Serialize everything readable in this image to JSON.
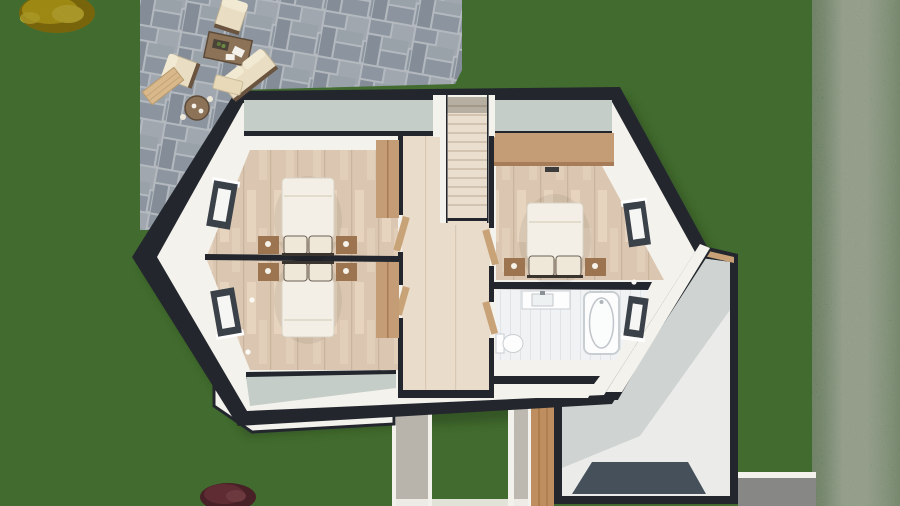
{
  "meta": {
    "kind": "3d-floorplan-top-down-render",
    "storey": "upper-floor-dollhouse-cutaway",
    "visible_text": ""
  },
  "environment": {
    "lawn": "grass lawn surrounding house",
    "hedge": "tall hedge along right edge",
    "patio": "grey paver patio, top left",
    "walkway": "gravel walkway at bottom centre",
    "gravel_strip": "gravel strip bottom right",
    "plants": [
      "yellow-shrub-top-left",
      "red-shrub-bottom"
    ]
  },
  "house": {
    "rooms": [
      {
        "name": "bedroom-top-left",
        "floor": "wood",
        "furniture": [
          "double-bed",
          "nightstand-left",
          "nightstand-right",
          "wardrobe"
        ]
      },
      {
        "name": "bedroom-bottom-left",
        "floor": "wood",
        "furniture": [
          "double-bed",
          "nightstand-left",
          "nightstand-right",
          "wardrobe"
        ]
      },
      {
        "name": "landing-hallway",
        "floor": "wood",
        "features": [
          "staircase",
          "open-doors"
        ]
      },
      {
        "name": "bedroom-right",
        "floor": "wood",
        "furniture": [
          "double-bed",
          "nightstand-left",
          "nightstand-right",
          "wardrobe-band",
          "floor-vent"
        ]
      },
      {
        "name": "bathroom",
        "floor": "white-tile",
        "fixtures": [
          "vanity-sink",
          "bathtub",
          "toilet"
        ]
      },
      {
        "name": "annex-lower-level",
        "floor": "pale",
        "features": [
          "dark-floor-mat",
          "wood-lintel"
        ]
      }
    ],
    "window_count": 4,
    "exterior": [
      "gable-wall-left",
      "gable-wall-right",
      "lower-bay-glass-roof",
      "front-door-wood-panel",
      "porch-step"
    ]
  },
  "patio_furniture": [
    "armchair",
    "armchair",
    "sofa",
    "coffee-table",
    "side-table",
    "wood-bench",
    "lounger-mat"
  ],
  "palette": {
    "grass": "#477E2E",
    "hedgeDark": "#5E8A48",
    "hedgeMid": "#7FA468",
    "hedgeLight": "#A9C291",
    "paverGrout": "#C2C8CE",
    "paverA": "#99A3AD",
    "paverB": "#AEB5BE",
    "paverC": "#8F99A4",
    "paverD": "#A6AEB7",
    "paverE": "#98A2AC",
    "wallDark": "#23272D",
    "wallWhite": "#F4F2ED",
    "wallCap": "#C5CDC8",
    "floorWood": "#DBC7B1",
    "floorWoodLight": "#E9D8C4",
    "floorWoodSeam": "#C9B49D",
    "floorHall": "#E9DCCA",
    "stairFloor": "#EADFCE",
    "stairTread": "#C9BCA6",
    "wardrobe": "#C49C75",
    "wardrobeSeam": "#A67D58",
    "doorWood": "#C9A378",
    "bedding": "#F3EFE6",
    "pillow": "#EFE8D8",
    "pillowLine": "#6B6157",
    "headboard": "#3A342E",
    "nightstand": "#9C7450",
    "tileFloor": "#F0F2F3",
    "tileLine": "#E0E4E6",
    "fixture": "#FDFDFD",
    "fixtureLine": "#C0C6CB",
    "windowFrame": "#3A4148",
    "windowGlass": "#F6F6F4",
    "glassBay": "#C9D0CD",
    "annexFloor": "#EBECEA",
    "annexWall": "#CFD4D2",
    "annexMat": "#46505A",
    "lintelWood": "#C8A176",
    "gravel": "#D8D3CA",
    "gravelCool": "#B5B5B3",
    "curb": "#F3F1EC",
    "frontDoor": "#BE8E60",
    "shrubYellow": "#E3C51D",
    "shrubYellowLight": "#F2DA3A",
    "shrubYellowDark": "#AD9110",
    "shrubRed": "#93454F",
    "shrubRedDark": "#6E343C",
    "shrubRedLight": "#A85862",
    "cushion": "#E9DEC3",
    "cushionLight": "#F2E9D3",
    "furnFrame": "#6A543F",
    "tableWood": "#8C7257",
    "benchWood": "#D9B98C",
    "shadowGreen": "#14240C"
  }
}
